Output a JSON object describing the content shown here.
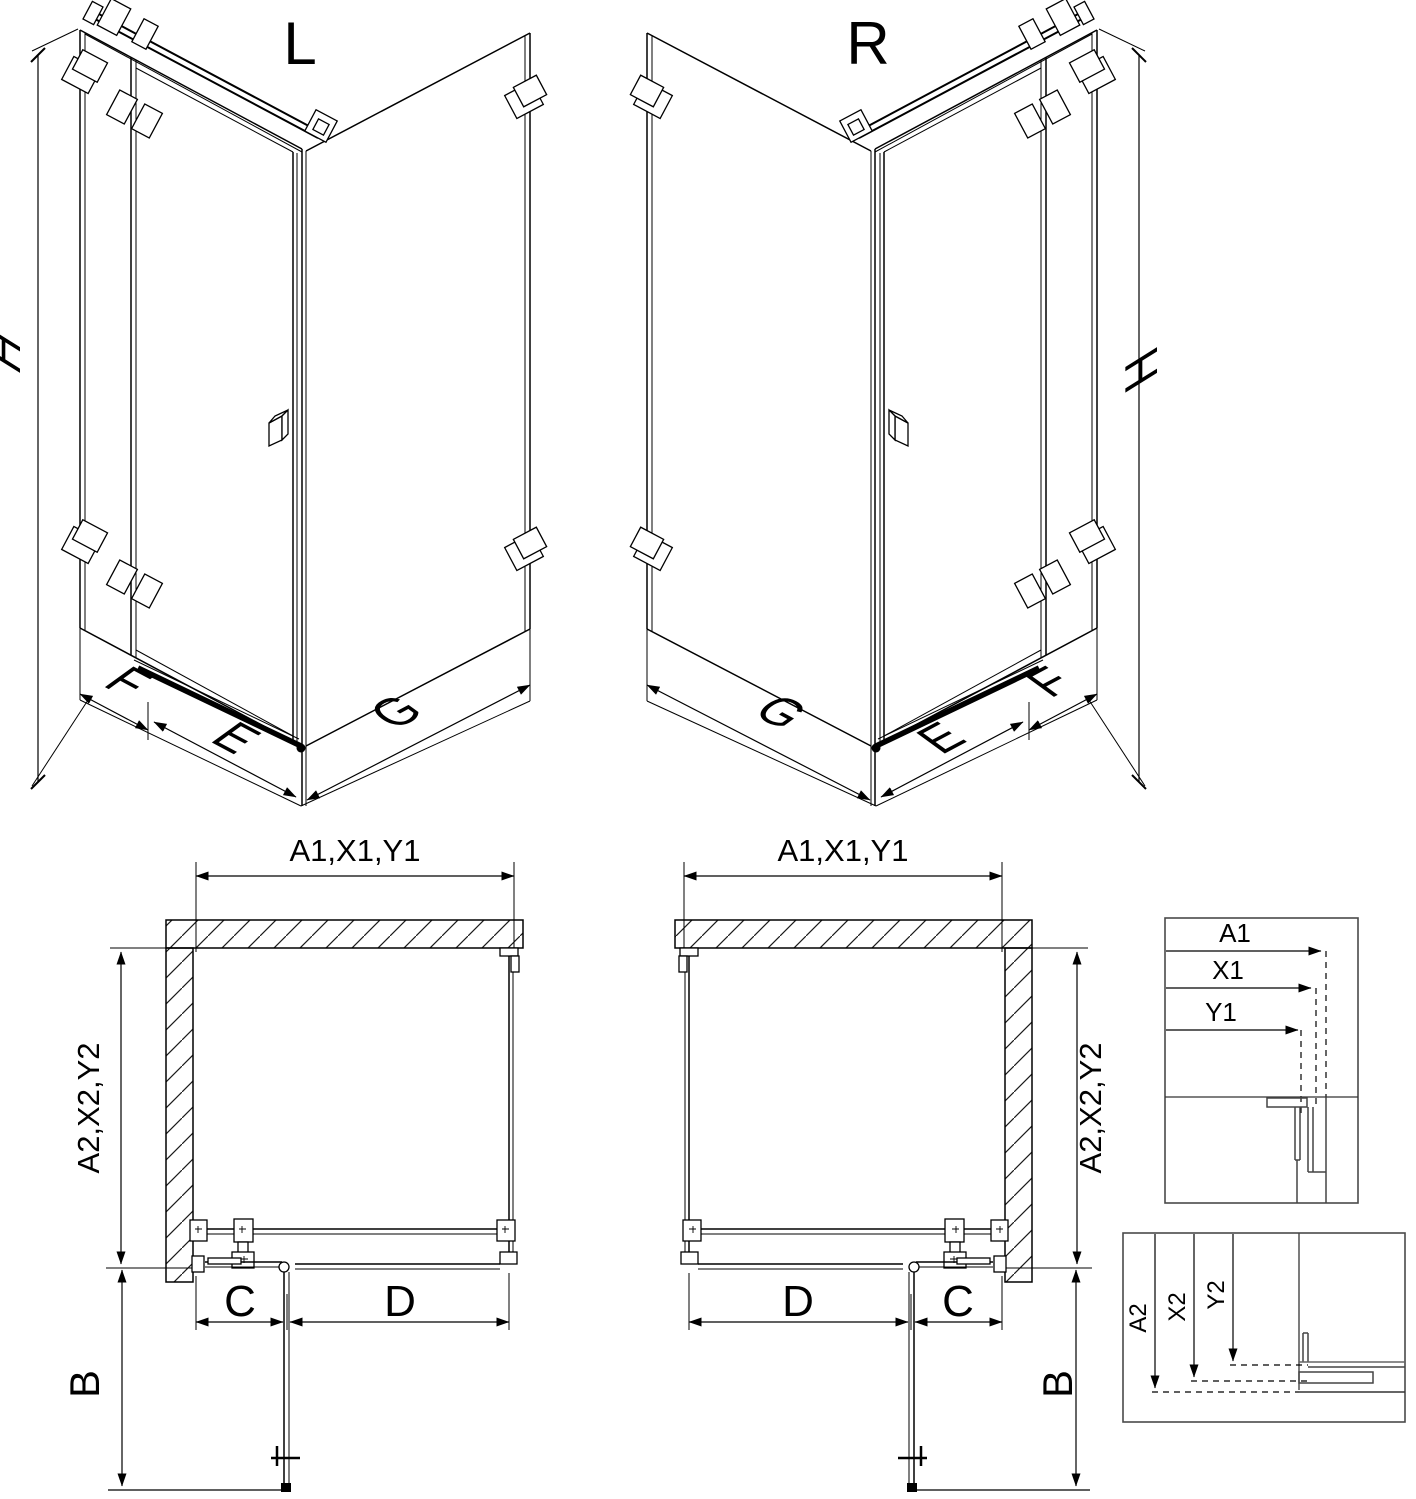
{
  "colors": {
    "line": "#000000",
    "detail_border": "#4a4a4a",
    "background": "#ffffff"
  },
  "iso_left": {
    "variant": "L",
    "height": "H",
    "side_panel": "F",
    "door_width": "E",
    "return_panel": "G"
  },
  "iso_right": {
    "variant": "R",
    "height": "H",
    "side_panel": "F",
    "door_width": "E",
    "return_panel": "G"
  },
  "plan_left": {
    "width": "A1,X1,Y1",
    "depth": "A2,X2,Y2",
    "fixed_segment": "C",
    "door_segment": "D",
    "door_opening": "B"
  },
  "plan_right": {
    "width": "A1,X1,Y1",
    "depth": "A2,X2,Y2",
    "fixed_segment": "C",
    "door_segment": "D",
    "door_opening": "B"
  },
  "detail_width": {
    "labels": [
      "A1",
      "X1",
      "Y1"
    ]
  },
  "detail_depth": {
    "labels": [
      "A2",
      "X2",
      "Y2"
    ]
  }
}
